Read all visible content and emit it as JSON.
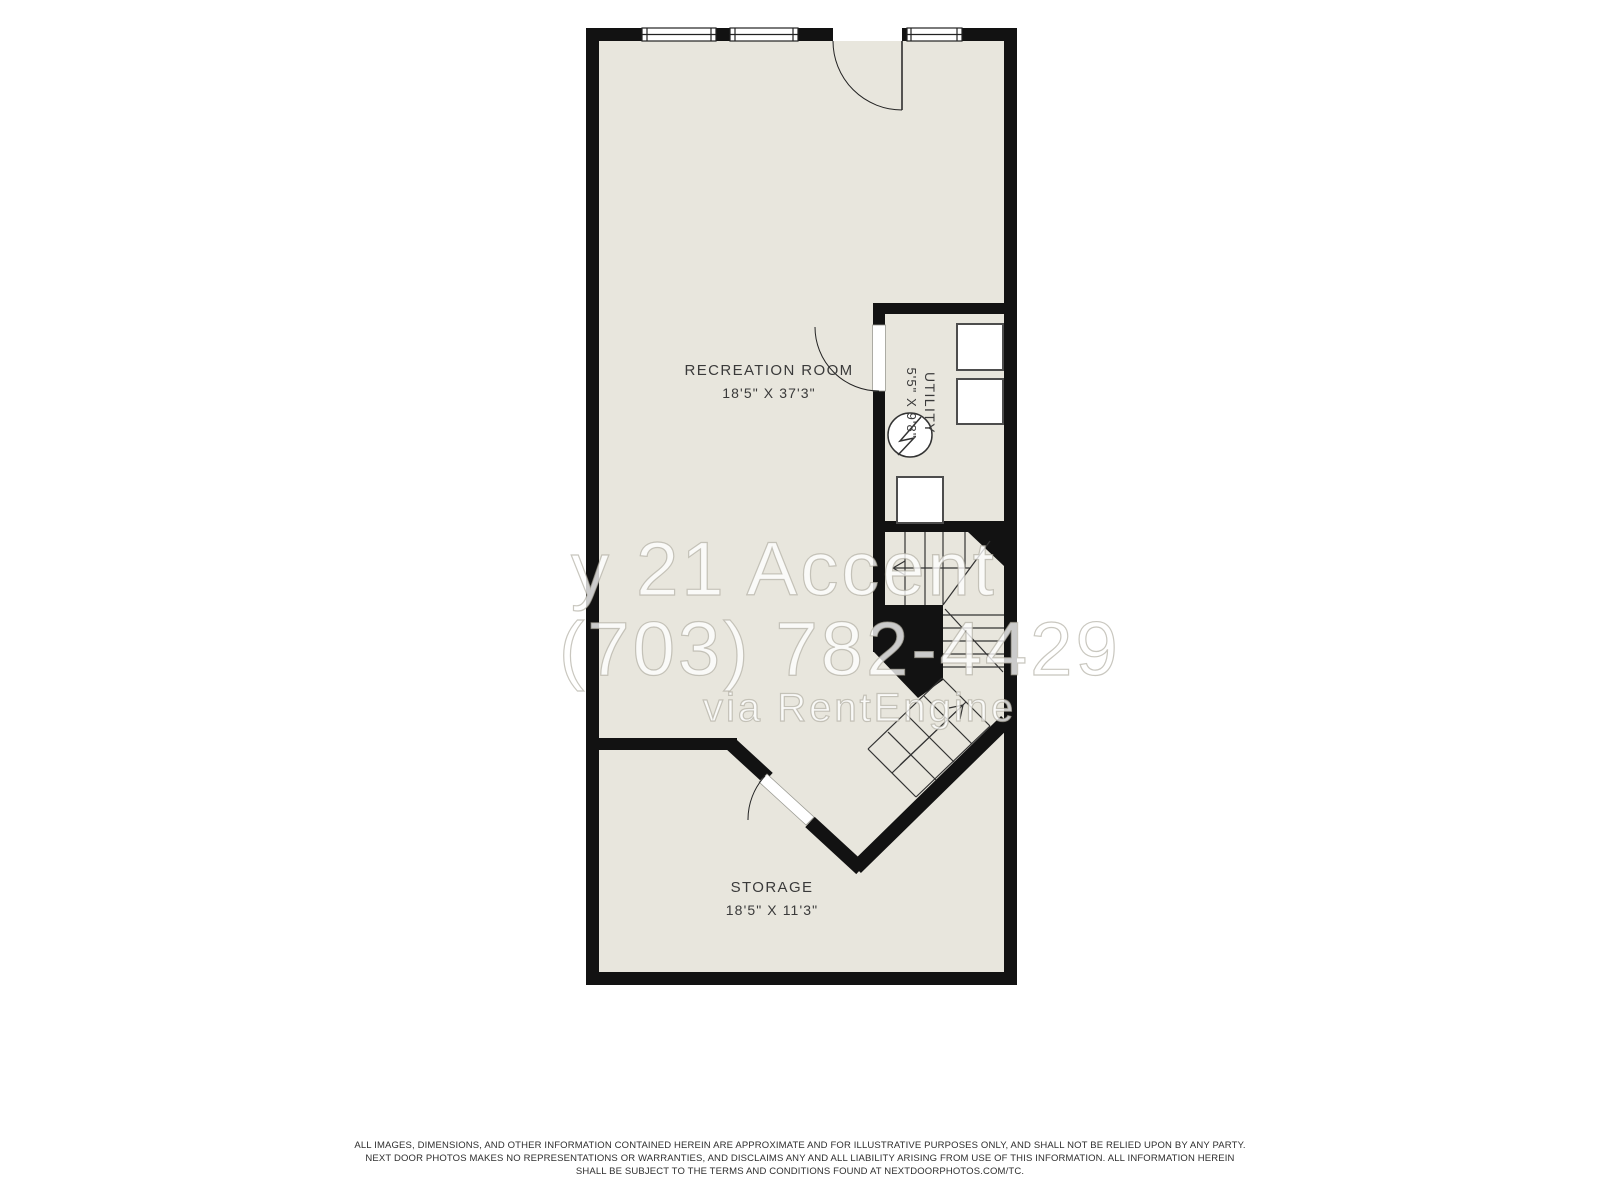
{
  "floor_plan": {
    "rooms": [
      {
        "name": "RECREATION ROOM",
        "dimensions": "18'5\" X 37'3\""
      },
      {
        "name": "UTILITY",
        "dimensions": "5'5\" X 9'8\""
      },
      {
        "name": "STORAGE",
        "dimensions": "18'5\" X 11'3\""
      }
    ],
    "watermark": {
      "line1": "y 21 Accent",
      "line2": "(703) 782-4429",
      "line3": "via RentEngine"
    },
    "disclaimer": {
      "line1": "ALL IMAGES, DIMENSIONS, AND OTHER INFORMATION CONTAINED HEREIN ARE APPROXIMATE AND FOR ILLUSTRATIVE PURPOSES ONLY, AND SHALL NOT BE RELIED UPON BY ANY PARTY.",
      "line2": "NEXT DOOR PHOTOS MAKES NO REPRESENTATIONS OR WARRANTIES, AND DISCLAIMS ANY AND ALL LIABILITY ARISING FROM USE OF THIS INFORMATION. ALL INFORMATION HEREIN",
      "line3": "SHALL BE SUBJECT TO THE TERMS AND CONDITIONS FOUND AT NEXTDOORPHOTOS.COM/TC."
    },
    "colors": {
      "wall": "#121212",
      "floor": "#e8e6dd",
      "label": "#3a3a3a",
      "line": "#333333"
    },
    "symbols": [
      "window",
      "door-swing",
      "stairs-up-arrow",
      "stairs-down-arrow",
      "water-heater",
      "washer",
      "dryer",
      "furnace"
    ]
  }
}
